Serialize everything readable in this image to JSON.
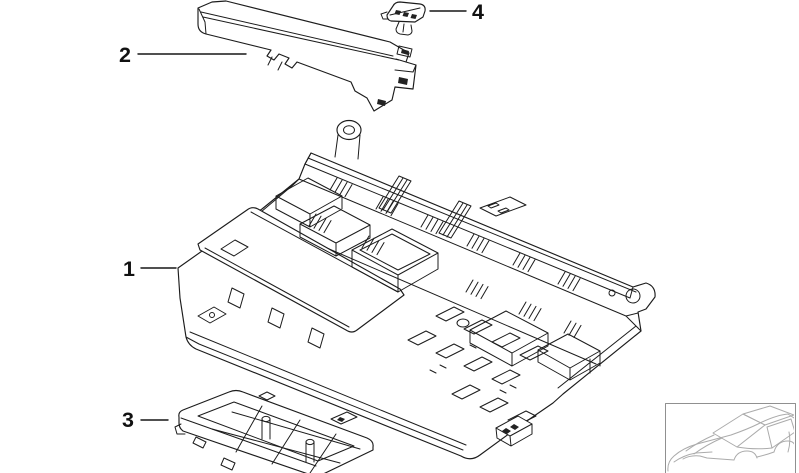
{
  "diagram": {
    "type": "exploded-parts-diagram",
    "background_color": "#ffffff",
    "line_color": "#1c1c1c",
    "label_color": "#111111",
    "callouts": [
      {
        "label": "1"
      },
      {
        "label": "2"
      },
      {
        "label": "3"
      },
      {
        "label": "4"
      }
    ],
    "thumbnail": {
      "icon": "car-silhouette-icon",
      "frame_color": "#909090",
      "car_line_color": "#ababab"
    }
  }
}
